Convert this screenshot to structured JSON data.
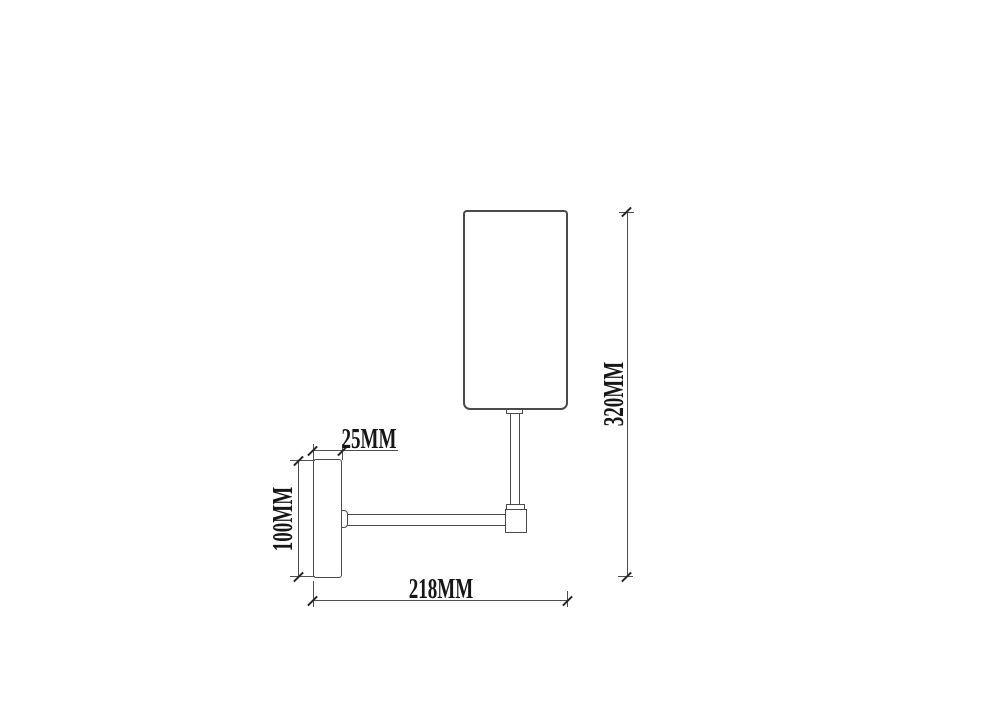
{
  "drawing": {
    "background_color": "#ffffff",
    "line_color": "#4f4f4f",
    "text_color": "#161616",
    "labels": {
      "plate_depth": "25MM",
      "plate_height": "100MM",
      "projection_width": "218MM",
      "overall_height": "320MM"
    }
  }
}
